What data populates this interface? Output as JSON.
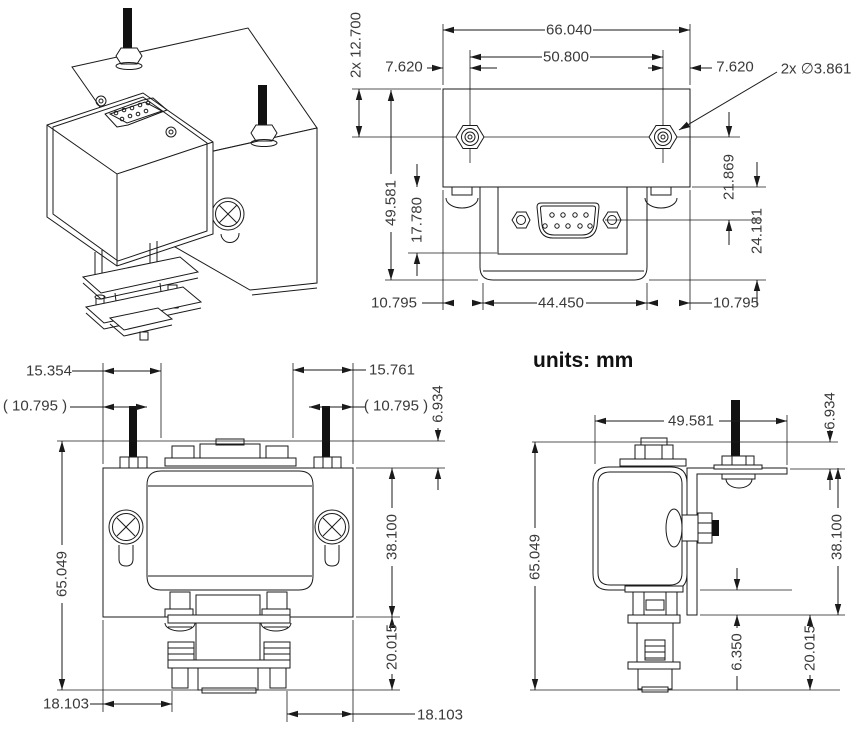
{
  "page": {
    "background": "#ffffff",
    "units_note": "units: mm"
  },
  "colors": {
    "line": "#1a1a1a",
    "text": "#3a3a3a"
  },
  "views": {
    "isometric": {
      "name": "isometric-assembly-view"
    },
    "front": {
      "name": "front-view-with-bracket",
      "dims": {
        "stud_standoff": "2x 12.700",
        "overall_width": "66.040",
        "hole_spacing": "50.800",
        "offset_left": "7.620",
        "offset_right": "7.620",
        "hole_diameter": "2x ∅3.861",
        "overall_height": "49.581",
        "connector_drop": "17.780",
        "hole_to_connector": "21.869",
        "connector_to_bottom": "24.181",
        "margin_left": "10.795",
        "body_width": "44.450",
        "margin_right": "10.795"
      }
    },
    "front_lower": {
      "name": "lower-front-view",
      "dims": {
        "stud_offset_left": "15.354",
        "stud_offset_right": "15.761",
        "ref_offset_left": "( 10.795 )",
        "ref_offset_right": "( 10.795 )",
        "connector_clearance": "6.934",
        "overall_height": "65.049",
        "plate_height": "38.100",
        "connector_height": "20.015",
        "foot_offset_left": "18.103",
        "foot_offset_right": "18.103"
      }
    },
    "side": {
      "name": "side-view",
      "dims": {
        "overall_depth": "49.581",
        "connector_clearance": "6.934",
        "overall_height": "65.049",
        "plate_height": "38.100",
        "body_to_plate_end": "6.350",
        "connector_height": "20.015"
      }
    }
  }
}
